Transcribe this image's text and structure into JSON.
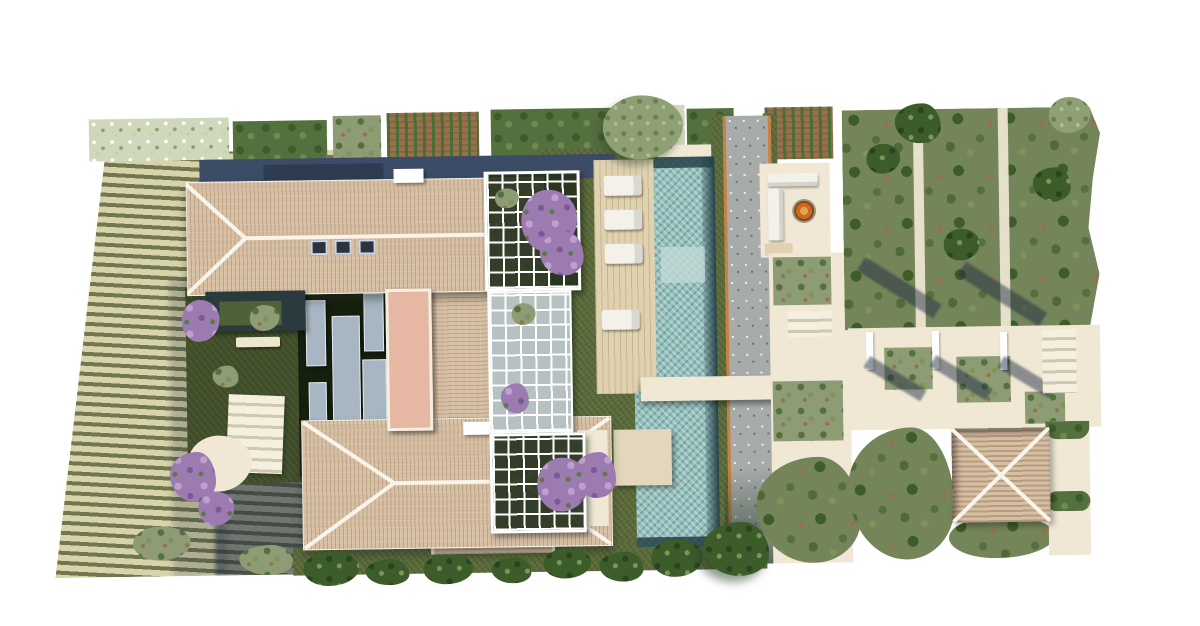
{
  "title": "aerial-villa-site-plan-rendering",
  "palette": {
    "bg": "#ffffff",
    "terraceCream": "#d9d3ab",
    "terraceOlive": "#70764e",
    "roofTile": "#d7bfa4",
    "ridgeWhite": "#f8f4ea",
    "navy": "#3c4b66",
    "navyDark": "#2e3c52",
    "lawn": "#5c6c3b",
    "lawnDark": "#46542e",
    "courtyard": "#161f0e",
    "glass": "#a7b6c2",
    "walkway": "#e6b8a3",
    "cream": "#f0e8d5",
    "creamDark": "#e2d7bc",
    "deck": "#e0d2b0",
    "lounger": "#f3f1ea",
    "poolAqua": "#93bfbc",
    "poolDark": "#25424a",
    "poolPale": "#c2dad6",
    "creek": "#a7acaa",
    "creekOrange": "#c9813f",
    "wisteria": "#9b7bb0",
    "wisteriaLight": "#bf9fd0",
    "shrub": "#8d9c74",
    "shrubDark": "#55703f",
    "tree": "#3c5c2a",
    "treeLight": "#7d9557",
    "soil": "#97704c",
    "fireGlow": "#e9a050",
    "fireRim": "#8a4516"
  },
  "scene": {
    "type": "top-down architectural rendering of a villa estate",
    "features": [
      "terraced vineyard slope with horizontal planting rows (west)",
      "kitchen-garden and hedge beds along north edge",
      "main house: north wing hip roof with skylights, east wing, south wing hip roof",
      "dark interior courtyard with glass roof panels and terracotta walkway bridge",
      "two white pergolas covered in purple wisteria plus glass link",
      "timber pool deck with sun loungers",
      "long lap pool with dark infinity edge, spa patch, crossing bridge and swim platform",
      "dry gravel creek with orange edging",
      "fire-pit lounge with L-shaped sofa and copper fire bowl",
      "olive orchard grid with cream paths and freestanding walls casting shadows",
      "pyramidal-roof garden pavilion with patio",
      "tree and hedge line along south boundary"
    ],
    "counts": {
      "sun_loungers": 4,
      "orchard_paths": 2,
      "pergolas": 2,
      "skylights": 3,
      "freestanding_walls": 3
    }
  }
}
